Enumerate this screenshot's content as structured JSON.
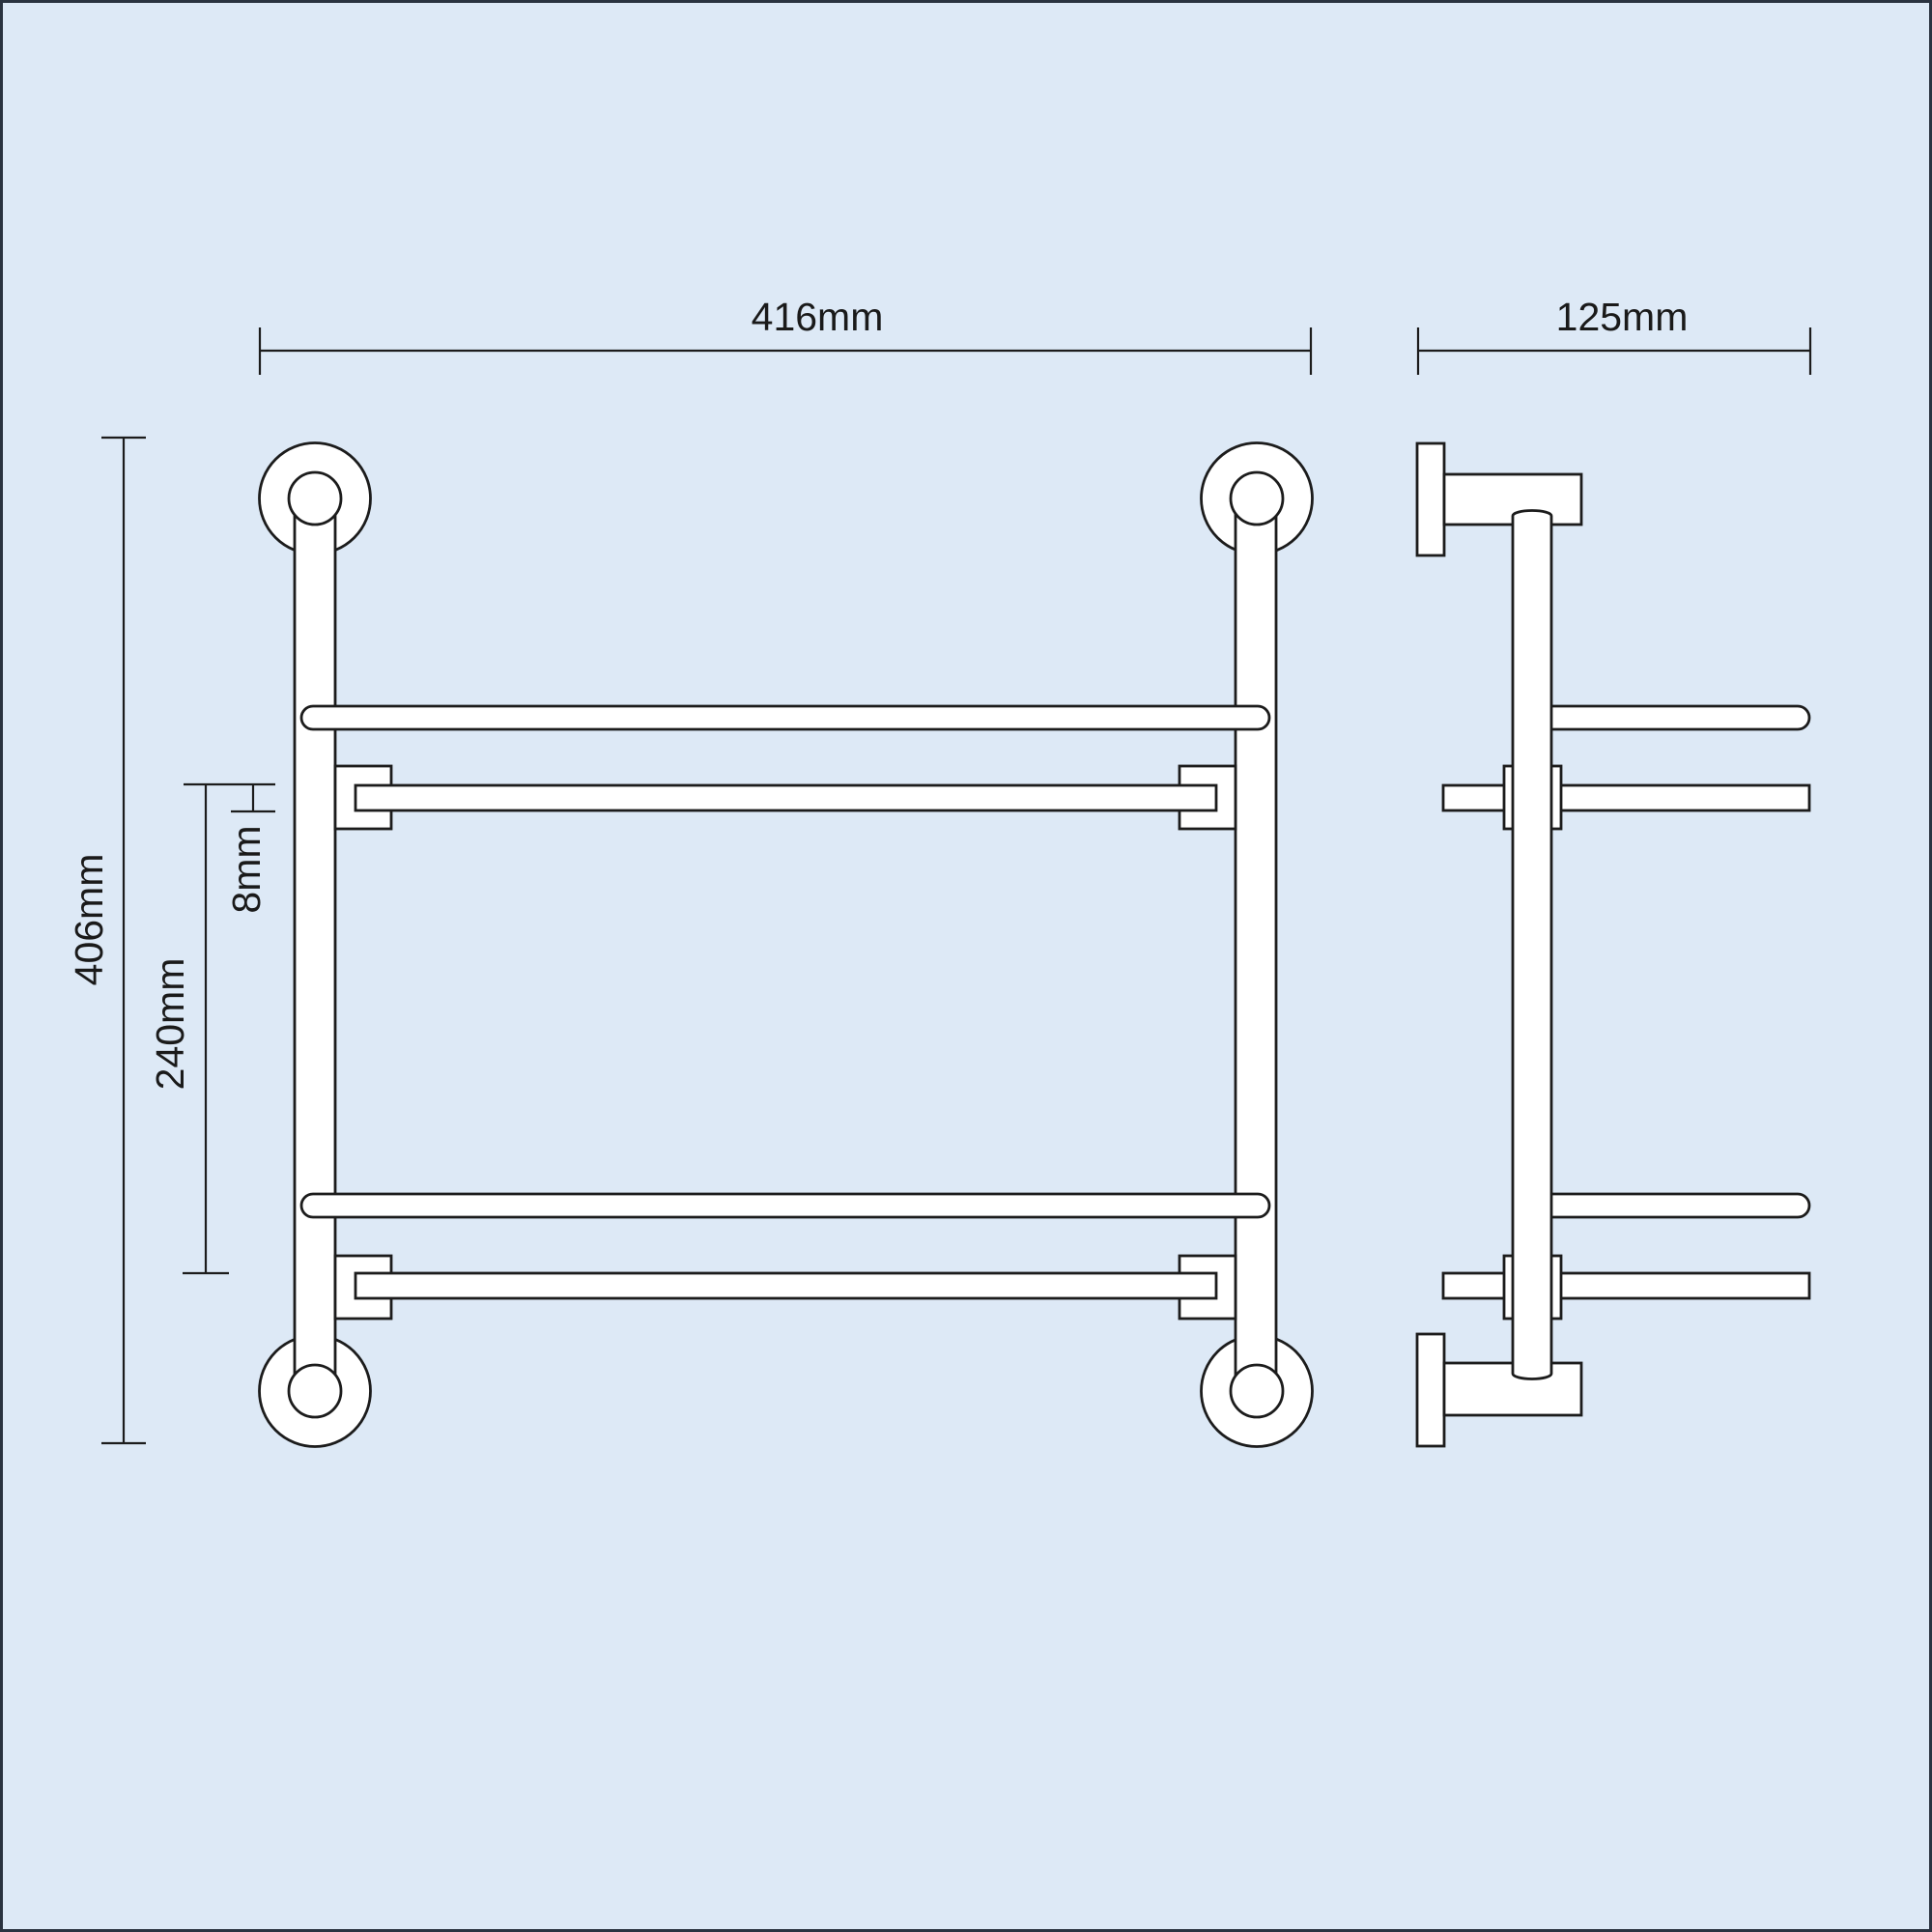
{
  "page": {
    "background_color": "#dde9f6",
    "border_color": "#2a3340",
    "line_color": "#1c1c1c",
    "shape_fill_color": "#ffffff"
  },
  "diagram": {
    "type": "technical-dimension-drawing",
    "views": {
      "front": "front-elevation",
      "side": "side-elevation"
    },
    "dimensions": {
      "front_width": "416mm",
      "side_depth": "125mm",
      "overall_height": "406mm",
      "shelf_spacing": "240mm",
      "shelf_thickness": "8mm"
    }
  }
}
